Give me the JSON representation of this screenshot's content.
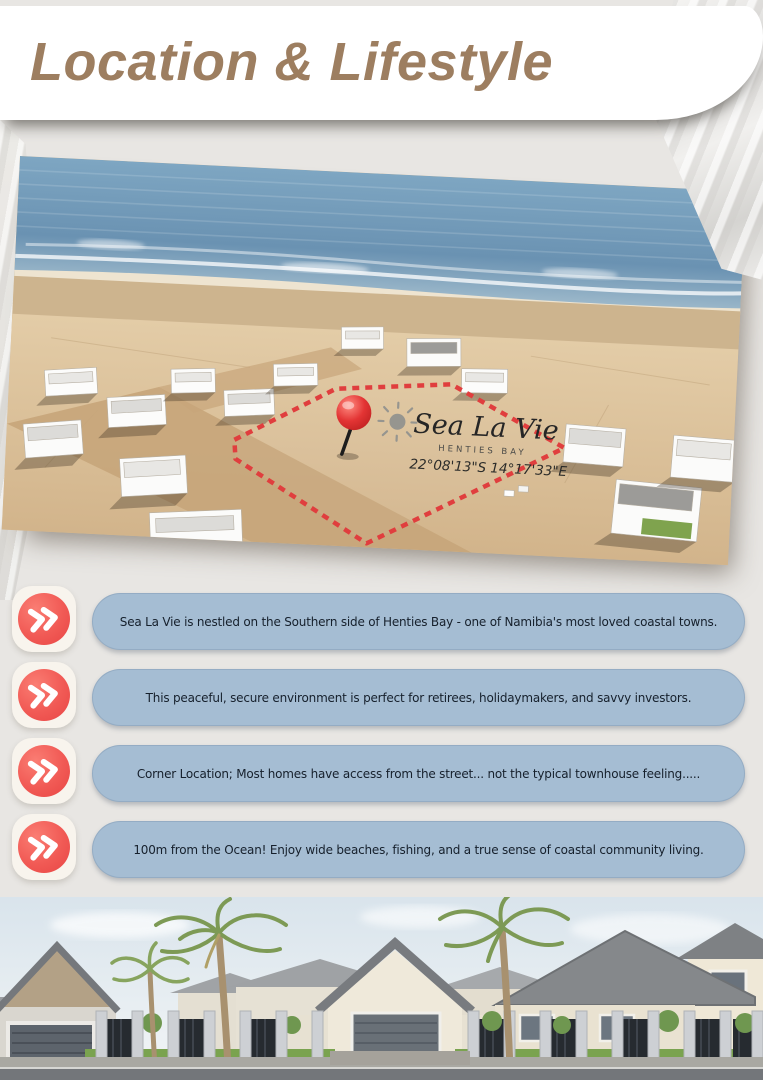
{
  "header": {
    "title": "Location & Lifestyle"
  },
  "aerial": {
    "brand": "Sea La Vie",
    "brand_location": "HENTIES BAY",
    "coordinates": "22°08'13\"S 14°17'33\"E"
  },
  "bullets": {
    "items": [
      {
        "text": "Sea La Vie is nestled on the Southern side of Henties Bay - one of Namibia's most loved coastal towns."
      },
      {
        "text": "This peaceful, secure environment is perfect for retirees, holidaymakers, and savvy investors."
      },
      {
        "text": "Corner Location; Most homes have access from the street... not the typical townhouse feeling....."
      },
      {
        "text": "100m from the Ocean! Enjoy wide beaches, fishing, and a true sense of coastal community living."
      }
    ]
  },
  "colors": {
    "accent_red": "#f15a55",
    "pill_blue": "#a5bdd3",
    "title_brown": "#9d7e60",
    "boundary_red": "#e03e3e"
  }
}
